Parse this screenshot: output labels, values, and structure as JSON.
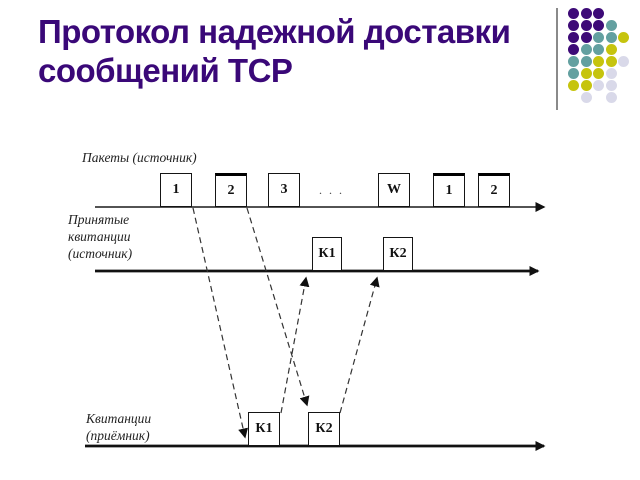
{
  "slide": {
    "title_lines": [
      "Протокол надежной доставки",
      "сообщений TCP"
    ],
    "title_color": "#3A0878"
  },
  "decoration": {
    "dot_colors": {
      "P": "#3D0A77",
      "T": "#63A0A0",
      "Y": "#C6C40E",
      "L": "#D9D9E9"
    },
    "dot_rows": [
      "PPP",
      "PPPT",
      "PPTTY",
      "PTTY",
      "TTYYL",
      "TYYL",
      "YYLL",
      ".L.L"
    ],
    "separator_color": "#8a8a8a"
  },
  "diagram": {
    "line_color": "#1a1a1a",
    "packets_timeline_label": "Пакеты (источник)",
    "received_acks_label": [
      "Принятые",
      "квитанции",
      "(источник)"
    ],
    "receiver_acks_label": [
      "Квитанции",
      "(приёмник)"
    ],
    "ellipsis": ". . .",
    "packet_boxes": [
      "1",
      "2",
      "3",
      "W",
      "1",
      "2"
    ],
    "source_ack_boxes": [
      "К1",
      "К2"
    ],
    "receiver_ack_boxes": [
      "К1",
      "К2"
    ]
  }
}
